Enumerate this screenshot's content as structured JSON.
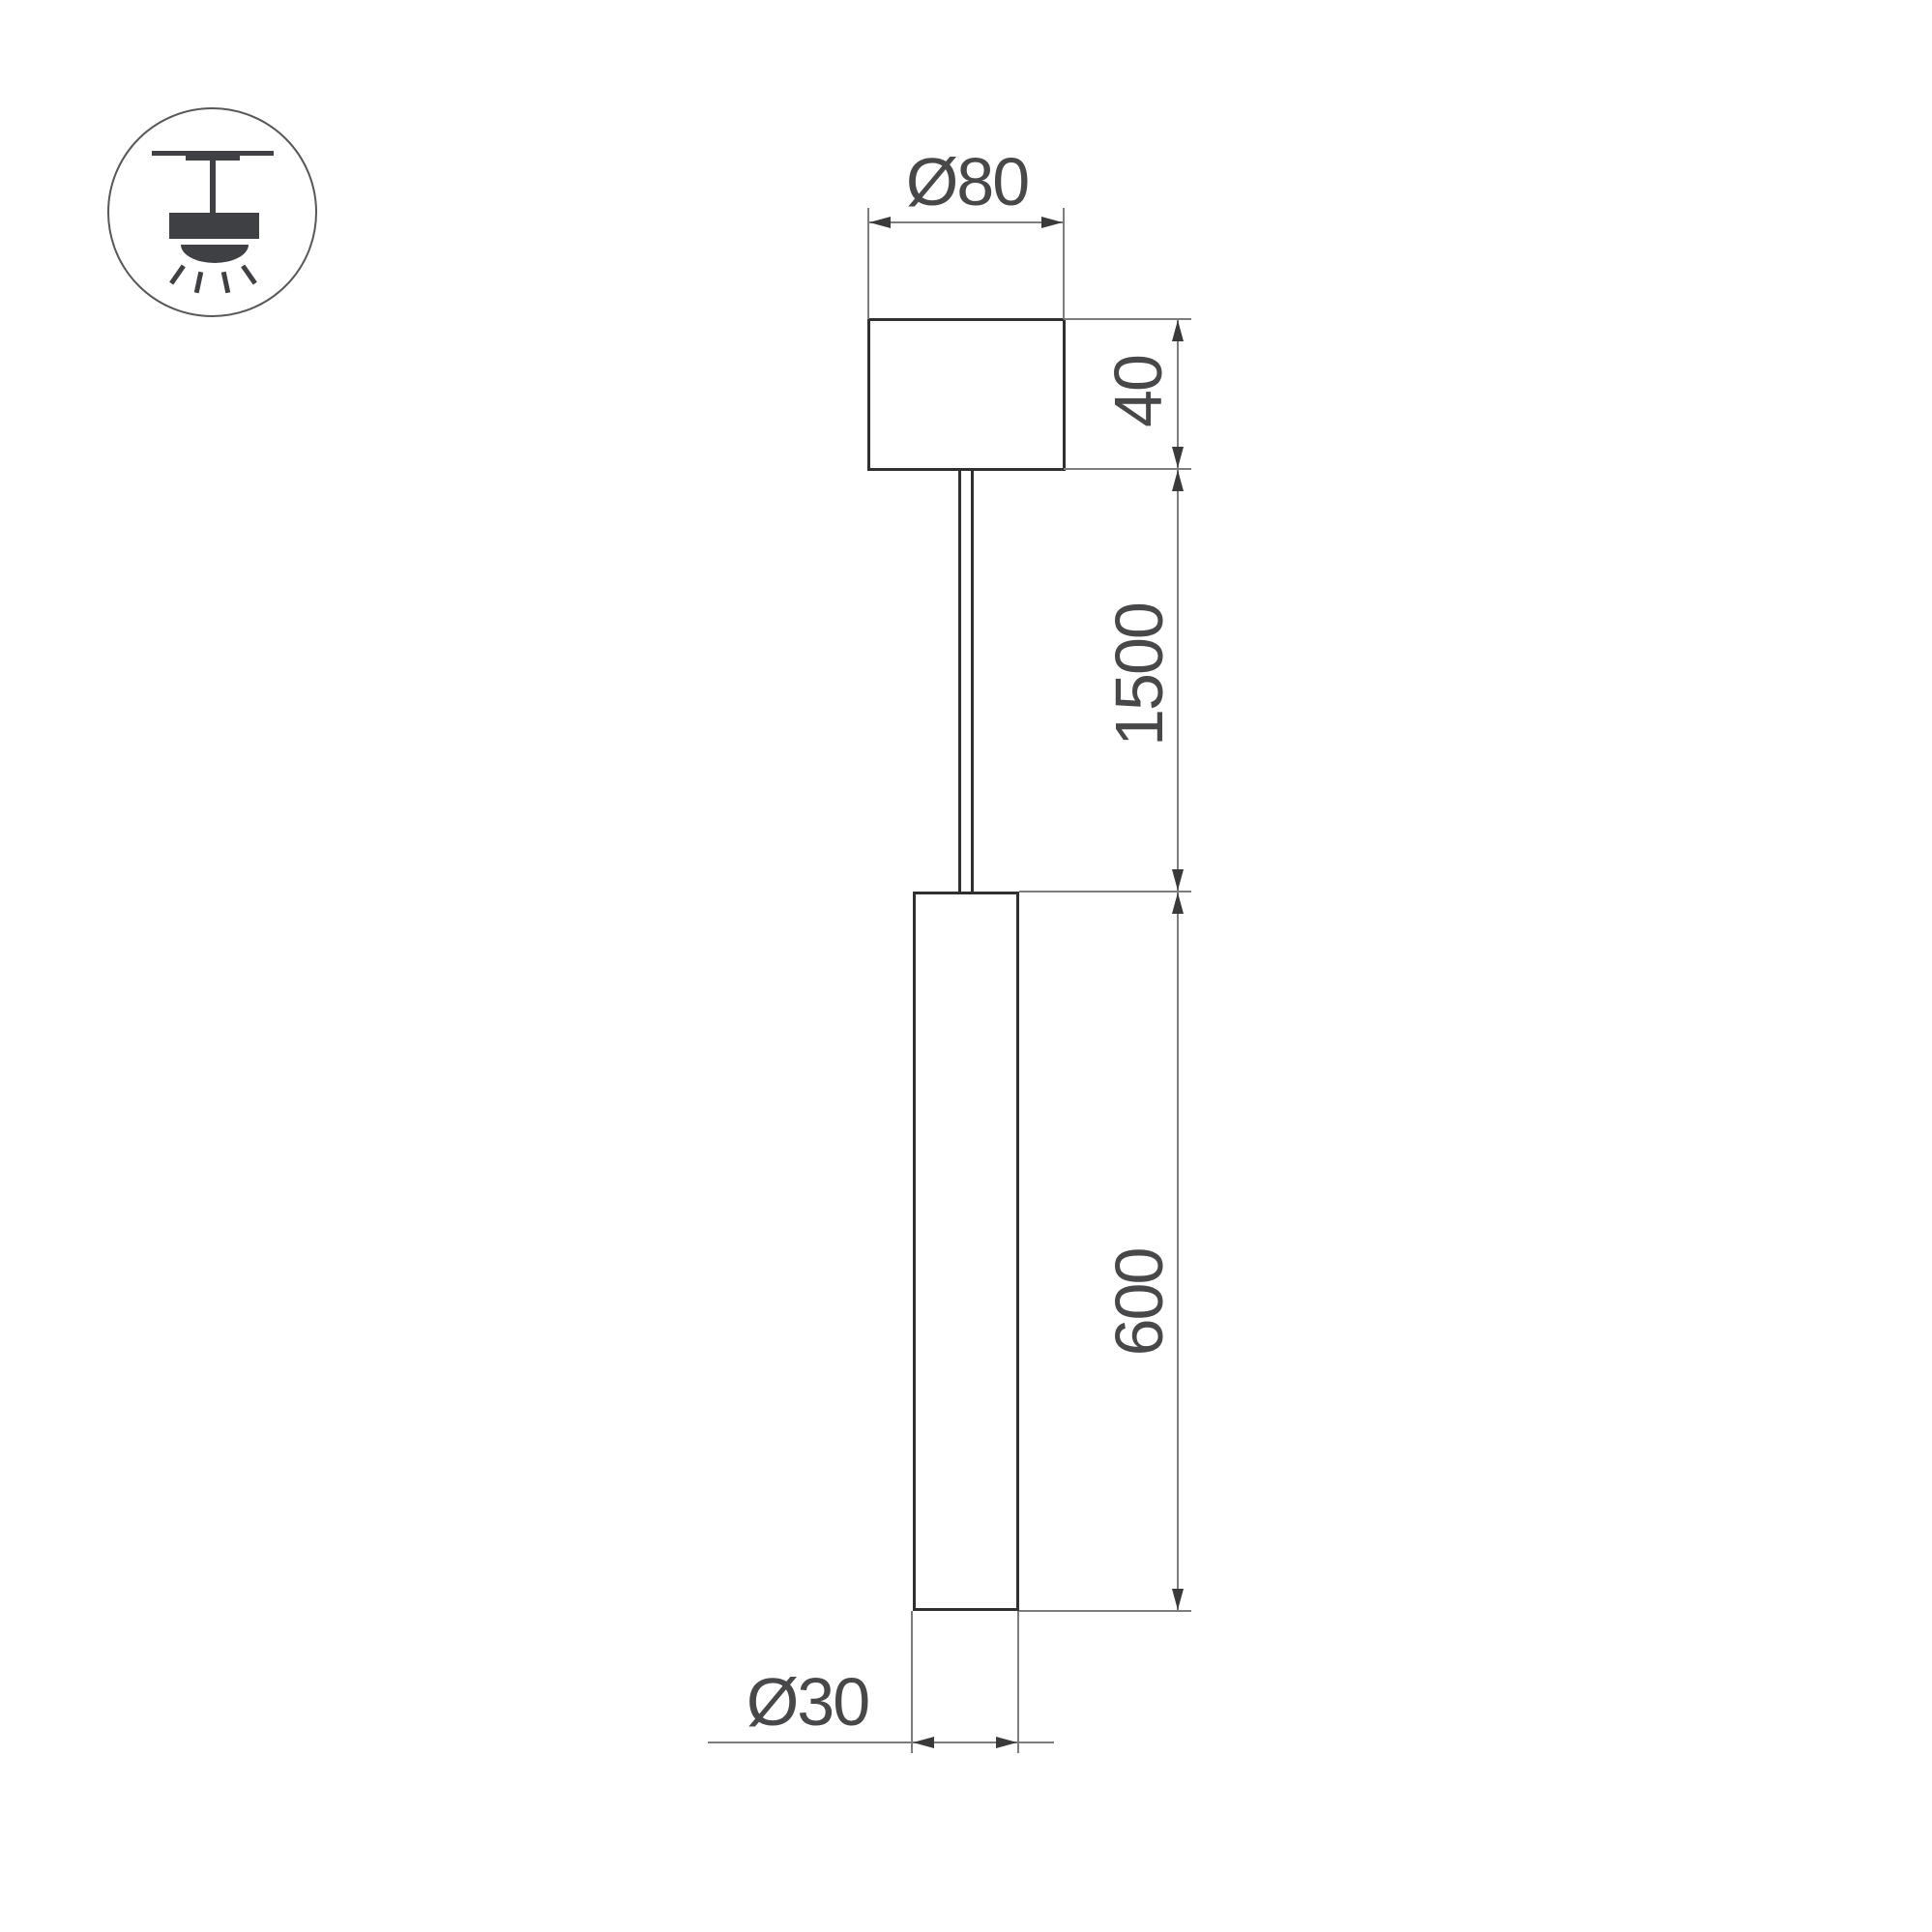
{
  "drawing": {
    "title": "pendant-light-dimension-drawing",
    "dimensions": {
      "canopy_diameter": "Ø80",
      "canopy_height": "40",
      "suspension_length": "1500",
      "tube_length": "600",
      "tube_diameter": "Ø30"
    },
    "icon": {
      "name": "pendant-ceiling-light"
    },
    "colors": {
      "background": "#ffffff",
      "object_stroke": "#303032",
      "thin_line": "#7d7d7d",
      "arrow": "#3a3a3c",
      "text": "#48484a",
      "icon": "#3f4043"
    }
  }
}
